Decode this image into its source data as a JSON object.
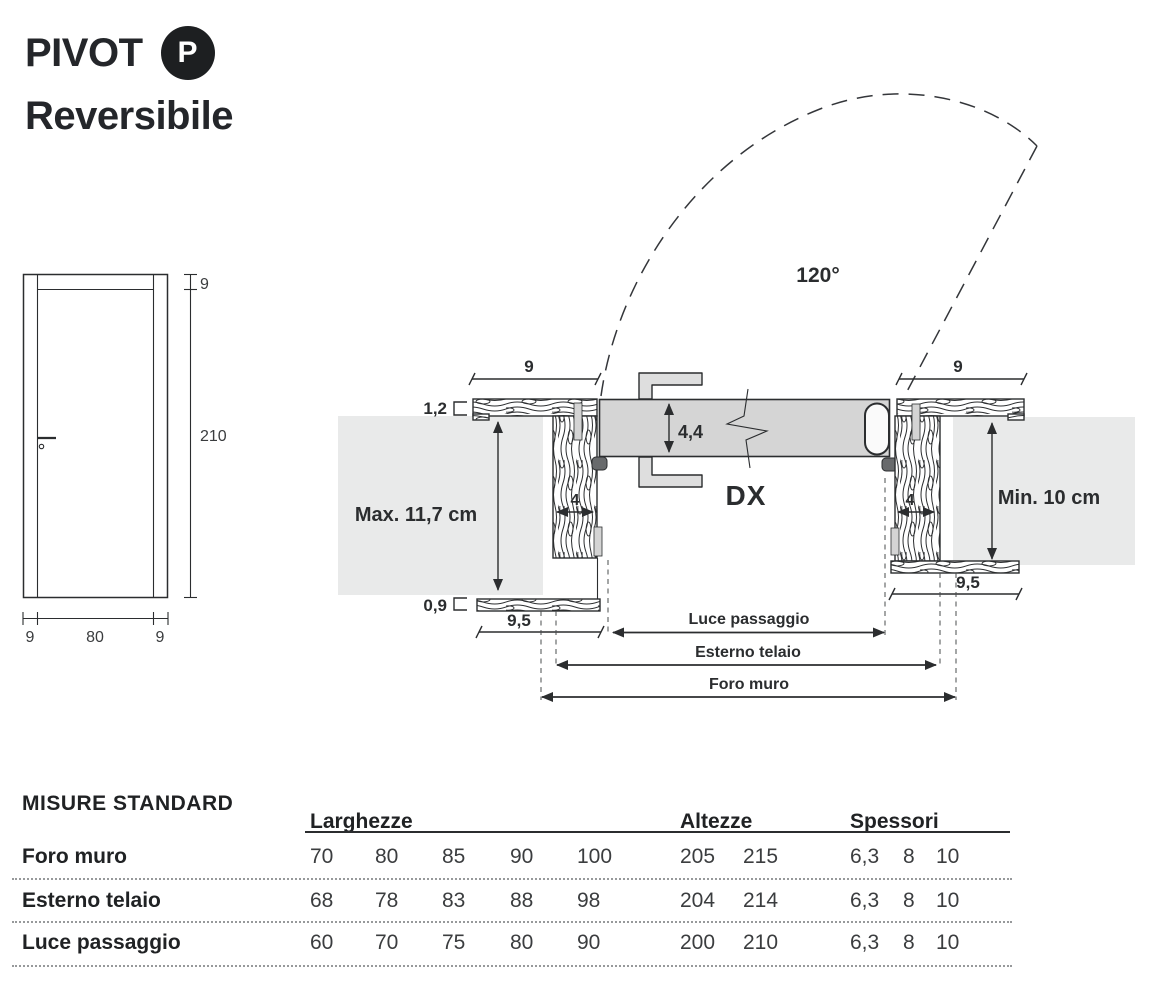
{
  "header": {
    "title": "PIVOT",
    "badge": "P",
    "subtitle": "Reversibile"
  },
  "colors": {
    "ink": "#2b2d2f",
    "leaf": "#d5d5d5",
    "wall": "#e9eaea",
    "badge_bg": "#1d1f21"
  },
  "elevation": {
    "top_rail": "9",
    "height": "210",
    "bottom_left": "9",
    "bottom_center": "80",
    "bottom_right": "9"
  },
  "plan": {
    "swing_angle": "120°",
    "hand": "DX",
    "leaf_thickness": "4,4",
    "left": {
      "architrave": "9",
      "reveal_top": "1,2",
      "wall_clearance": "Max. 11,7 cm",
      "jamb_depth": "4",
      "reveal_bottom": "0,9",
      "counter_architrave": "9,5"
    },
    "right": {
      "architrave": "9",
      "wall_clearance": "Min. 10 cm",
      "jamb_depth": "4",
      "counter_architrave": "9,5"
    },
    "dimensions": {
      "luce": "Luce passaggio",
      "esterno": "Esterno telaio",
      "foro": "Foro muro"
    }
  },
  "table": {
    "title": "MISURE STANDARD",
    "col_groups": [
      "Larghezze",
      "Altezze",
      "Spessori"
    ],
    "rows": [
      {
        "label": "Foro muro",
        "larghezze": [
          "70",
          "80",
          "85",
          "90",
          "100"
        ],
        "altezze": [
          "205",
          "215"
        ],
        "spessori": [
          "6,3",
          "8",
          "10"
        ]
      },
      {
        "label": "Esterno telaio",
        "larghezze": [
          "68",
          "78",
          "83",
          "88",
          "98"
        ],
        "altezze": [
          "204",
          "214"
        ],
        "spessori": [
          "6,3",
          "8",
          "10"
        ]
      },
      {
        "label": "Luce passaggio",
        "larghezze": [
          "60",
          "70",
          "75",
          "80",
          "90"
        ],
        "altezze": [
          "200",
          "210"
        ],
        "spessori": [
          "6,3",
          "8",
          "10"
        ]
      }
    ]
  }
}
